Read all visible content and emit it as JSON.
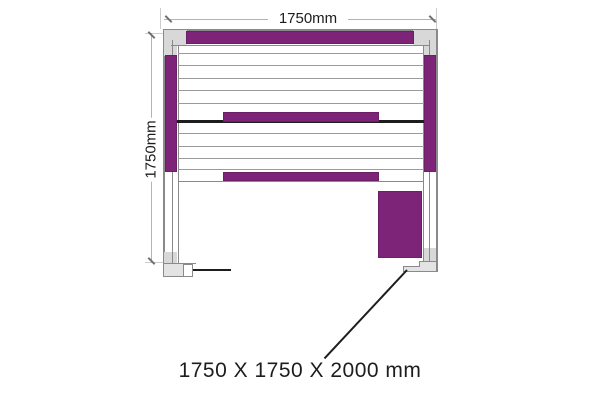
{
  "diagram": {
    "type": "sauna-floor-plan",
    "width_label": "1750mm",
    "height_label": "1750mm",
    "overall_label": "1750 X 1750 X 2000 mm"
  },
  "colors": {
    "heater": "#7d2478",
    "wall_line": "#8a8a8a",
    "wall_fill": "#d8d8d8",
    "slat_line": "#9b9b9b",
    "dim_line": "#b3b3b3",
    "ink": "#1d1d1d"
  }
}
